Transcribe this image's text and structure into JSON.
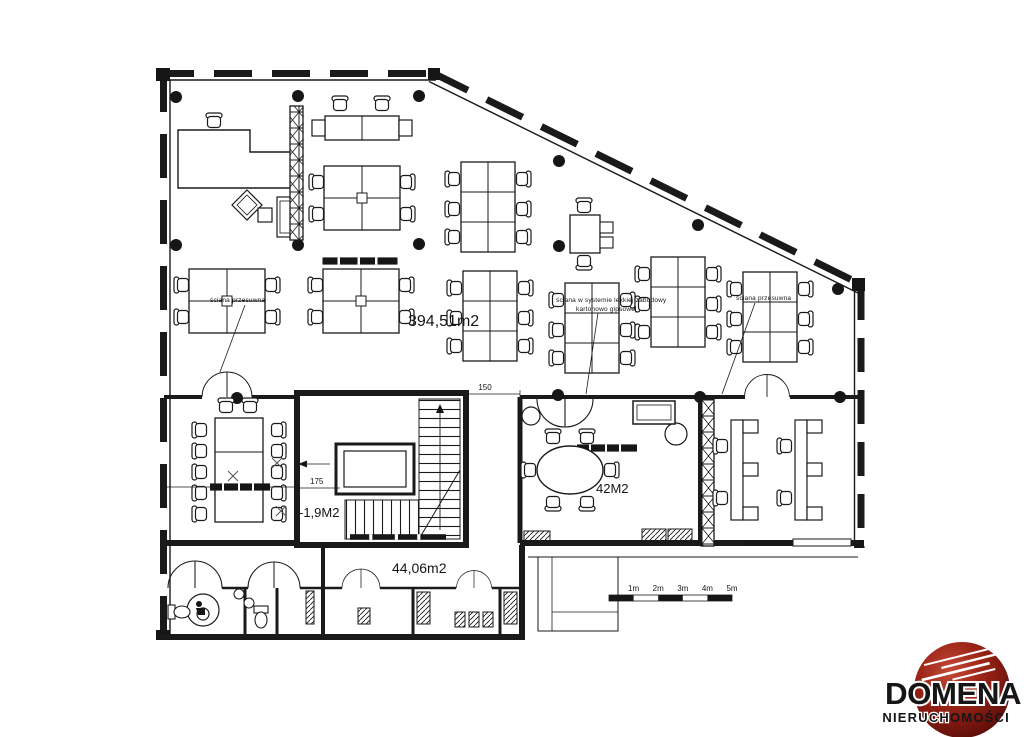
{
  "plan": {
    "areas": {
      "open_office": "394,51m2",
      "room_42": "42M2",
      "stairwell": "-1,9M2",
      "annex": "44,06m2"
    },
    "dimensions": {
      "corridor_width": "150",
      "stair_landing": "175"
    },
    "notes": {
      "sliding_wall_left": "ściana przesuwna",
      "sliding_wall_right": "ściana przesuwna",
      "partition_line1": "ściana w systemie lekkiej zabudowy",
      "partition_line2": "kartonowo gipsowej"
    }
  },
  "scale_bar": {
    "m1": "1m",
    "m2": "2m",
    "m3": "3m",
    "m4": "4m",
    "m5": "5m"
  },
  "logo": {
    "name": "DOMENA",
    "sub_left": "NIERUCH",
    "sub_right": "OMOŚCI",
    "red": "#8e1c10",
    "ink": "#161616"
  }
}
